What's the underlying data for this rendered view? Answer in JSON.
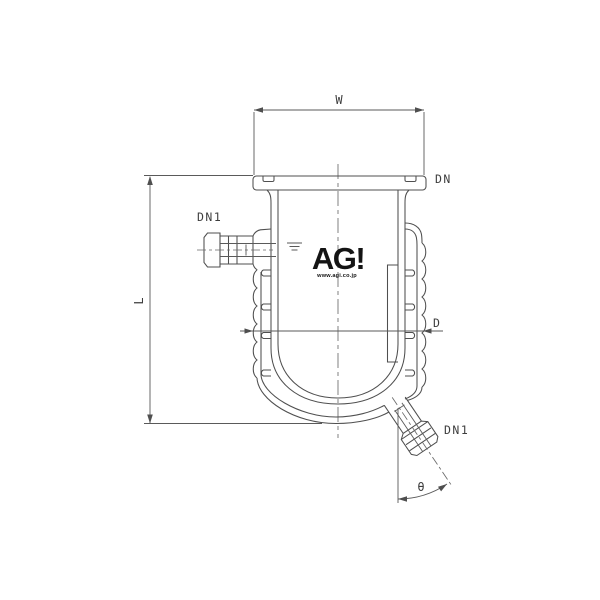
{
  "colors": {
    "background": "#ffffff",
    "line": "#4f4f4f",
    "label_text": "#3d3d3d",
    "logo_text": "#141414"
  },
  "labels": {
    "width": "W",
    "top_flange": "DN",
    "side_nozzle": "DN1",
    "height": "L",
    "diameter": "D",
    "bottom_valve": "DN1",
    "valve_angle": "θ"
  },
  "logo": {
    "text": "AG!",
    "url": "www.agi.co.jp"
  }
}
